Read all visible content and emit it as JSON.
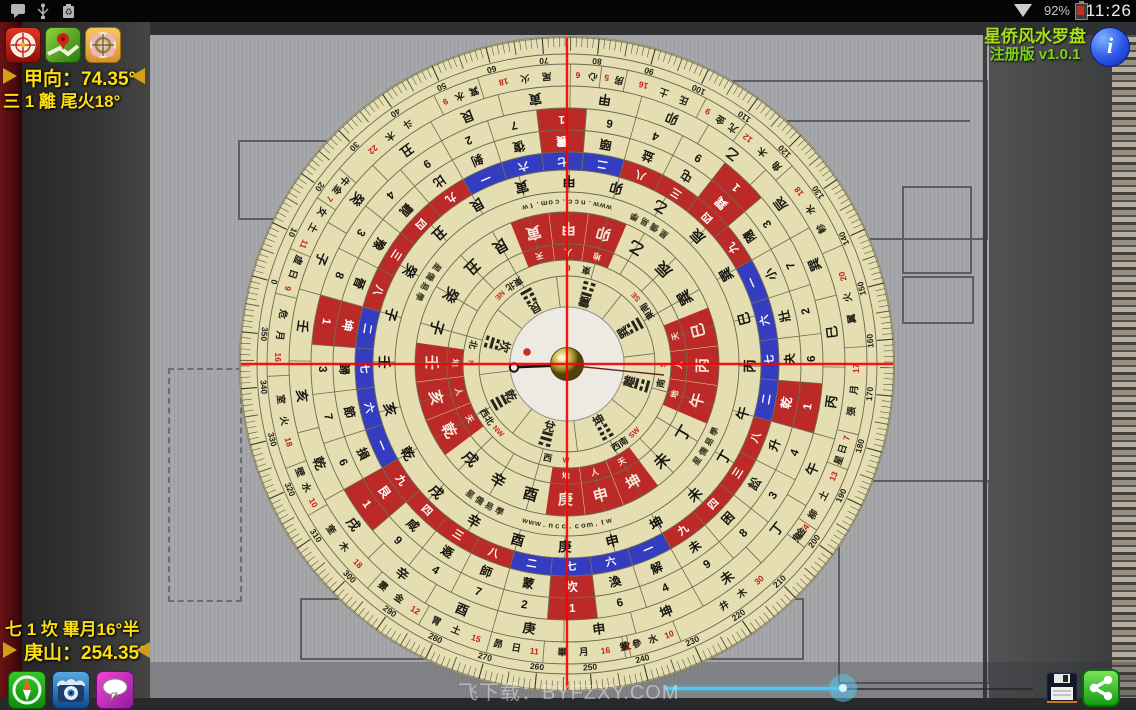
{
  "status_bar": {
    "time": "11:26",
    "battery": "92%",
    "left_icons": [
      "message-icon",
      "usb-icon",
      "battery-recycle-icon"
    ],
    "right_icons": [
      "wifi-icon",
      "battery-icon"
    ]
  },
  "app_info": {
    "title": "星侨风水罗盘",
    "edition": "注册版 v1.0.1",
    "info_glyph": "i"
  },
  "readouts": {
    "facing_label": "甲向：74.35°",
    "facing_detail": "三 1 離 尾火18°",
    "sitting_detail": "七 1 坎 畢月16°半",
    "sitting_label": "庚山：254.35°"
  },
  "watermark": "飞下载：BYFZXY.COM",
  "toolbars": {
    "top": [
      "luopan-app-icon",
      "map-locate-icon",
      "camera-overlay-icon"
    ],
    "bottom": [
      "compass-mode-icon",
      "camera-view-icon",
      "comment-icon"
    ],
    "actions": [
      "save-icon",
      "share-icon"
    ]
  },
  "slider": {
    "handle_pct": 48
  },
  "compass": {
    "facing_deg": 74.35,
    "sitting_deg": 254.35,
    "disc_color": "#e5deb2",
    "red_color": "#bb2a26",
    "blue_color": "#343cc0",
    "crosshair_color": "#f50400",
    "mountains_24": [
      "子",
      "癸",
      "丑",
      "艮",
      "寅",
      "甲",
      "卯",
      "乙",
      "辰",
      "巽",
      "巳",
      "丙",
      "午",
      "丁",
      "未",
      "坤",
      "申",
      "庚",
      "酉",
      "辛",
      "戌",
      "乾",
      "亥",
      "壬"
    ],
    "red_mountains": [
      "寅",
      "甲",
      "卯",
      "巳",
      "丙",
      "午",
      "坤",
      "申",
      "庚",
      "乾",
      "亥",
      "壬"
    ],
    "band_sub_labels": {
      "寅": "天",
      "甲": "人",
      "卯": "地",
      "巳": "天",
      "丙": "人",
      "午": "地",
      "坤": "天",
      "申": "人",
      "庚": "地",
      "乾": "天",
      "亥": "人",
      "壬": "地"
    },
    "bagua": [
      {
        "name": "坎",
        "deg": 0,
        "lines": "010"
      },
      {
        "name": "艮",
        "deg": 45,
        "lines": "001"
      },
      {
        "name": "震",
        "deg": 90,
        "lines": "100"
      },
      {
        "name": "巽",
        "deg": 135,
        "lines": "011"
      },
      {
        "name": "離",
        "deg": 180,
        "lines": "101"
      },
      {
        "name": "坤",
        "deg": 225,
        "lines": "000"
      },
      {
        "name": "兌",
        "deg": 270,
        "lines": "110"
      },
      {
        "name": "乾",
        "deg": 315,
        "lines": "111"
      }
    ],
    "directions": [
      {
        "zh": "北",
        "en": "N",
        "deg": 0
      },
      {
        "zh": "東北",
        "en": "NE",
        "deg": 45
      },
      {
        "zh": "東",
        "en": "E",
        "deg": 90
      },
      {
        "zh": "東南",
        "en": "SE",
        "deg": 135
      },
      {
        "zh": "南",
        "en": "S",
        "deg": 180
      },
      {
        "zh": "西南",
        "en": "SW",
        "deg": 225
      },
      {
        "zh": "西",
        "en": "W",
        "deg": 270
      },
      {
        "zh": "西北",
        "en": "NW",
        "deg": 315
      }
    ],
    "numeral_blue": [
      "一",
      "六",
      "七",
      "二"
    ],
    "numeral_red": [
      "八",
      "三",
      "四",
      "九"
    ],
    "hexagram_ring": [
      "晉",
      "豫",
      "觀",
      "比",
      "剝",
      "復",
      "震",
      "頤",
      "益",
      "屯",
      "巽",
      "隨",
      "小",
      "壯",
      "夬",
      "乾",
      "升",
      "訟",
      "困",
      "未",
      "解",
      "渙",
      "坎",
      "蒙",
      "師",
      "遯",
      "咸",
      "艮",
      "損",
      "節",
      "歸",
      "坤"
    ],
    "digit_ring": [
      8,
      3,
      4,
      9,
      2,
      7,
      1,
      6,
      4,
      9,
      1,
      3,
      7,
      2,
      6,
      1,
      4,
      3,
      8,
      9,
      4,
      6,
      1,
      2,
      7,
      4,
      9,
      1,
      6,
      7,
      3,
      1
    ],
    "axis_red_indices": [
      6,
      10,
      15,
      22,
      27,
      31
    ],
    "mansions": [
      {
        "n": "尾火",
        "v": "18",
        "s": 57,
        "e": 75
      },
      {
        "n": "心",
        "v": "6",
        "s": 75,
        "e": 81
      },
      {
        "n": "房",
        "v": "5",
        "s": 81,
        "e": 86
      },
      {
        "n": "氐土",
        "v": "16",
        "s": 86,
        "e": 102
      },
      {
        "n": "亢金",
        "v": "9",
        "s": 102,
        "e": 111
      },
      {
        "n": "角木",
        "v": "12",
        "s": 111,
        "e": 123
      },
      {
        "n": "軫水",
        "v": "18",
        "s": 123,
        "e": 141
      },
      {
        "n": "翼火",
        "v": "20",
        "s": 141,
        "e": 161
      },
      {
        "n": "張月",
        "v": "17",
        "s": 161,
        "e": 178
      },
      {
        "n": "星日",
        "v": "7",
        "s": 178,
        "e": 185
      },
      {
        "n": "柳土",
        "v": "13",
        "s": 185,
        "e": 198
      },
      {
        "n": "鬼金",
        "v": "4",
        "s": 198,
        "e": 202
      },
      {
        "n": "井木",
        "v": "30",
        "s": 202,
        "e": 232
      },
      {
        "n": "參水",
        "v": "10",
        "s": 232,
        "e": 242
      },
      {
        "n": "觜火",
        "v": "1",
        "s": 242,
        "e": 243
      },
      {
        "n": "畢月",
        "v": "16",
        "s": 243,
        "e": 259
      },
      {
        "n": "昴日",
        "v": "11",
        "s": 259,
        "e": 270
      },
      {
        "n": "胃土",
        "v": "15",
        "s": 270,
        "e": 284
      },
      {
        "n": "婁金",
        "v": "12",
        "s": 284,
        "e": 296
      },
      {
        "n": "奎木",
        "v": "18",
        "s": 296,
        "e": 314
      },
      {
        "n": "壁水",
        "v": "10",
        "s": 314,
        "e": 324
      },
      {
        "n": "室火",
        "v": "18",
        "s": 324,
        "e": 342
      },
      {
        "n": "危月",
        "v": "16",
        "s": 342,
        "e": 358
      },
      {
        "n": "虛日",
        "v": "9",
        "s": 358,
        "e": 367
      },
      {
        "n": "女土",
        "v": "11",
        "s": 367,
        "e": 378
      },
      {
        "n": "牛金",
        "v": "7",
        "s": 378,
        "e": 385
      },
      {
        "n": "斗木",
        "v": "22",
        "s": 385,
        "e": 408
      },
      {
        "n": "箕水",
        "v": "9",
        "s": 408,
        "e": 417
      }
    ],
    "brand_text": "www.ncc.com.tw",
    "school_text": "星僑易學",
    "degree_step": 10,
    "degree_max": 350
  }
}
